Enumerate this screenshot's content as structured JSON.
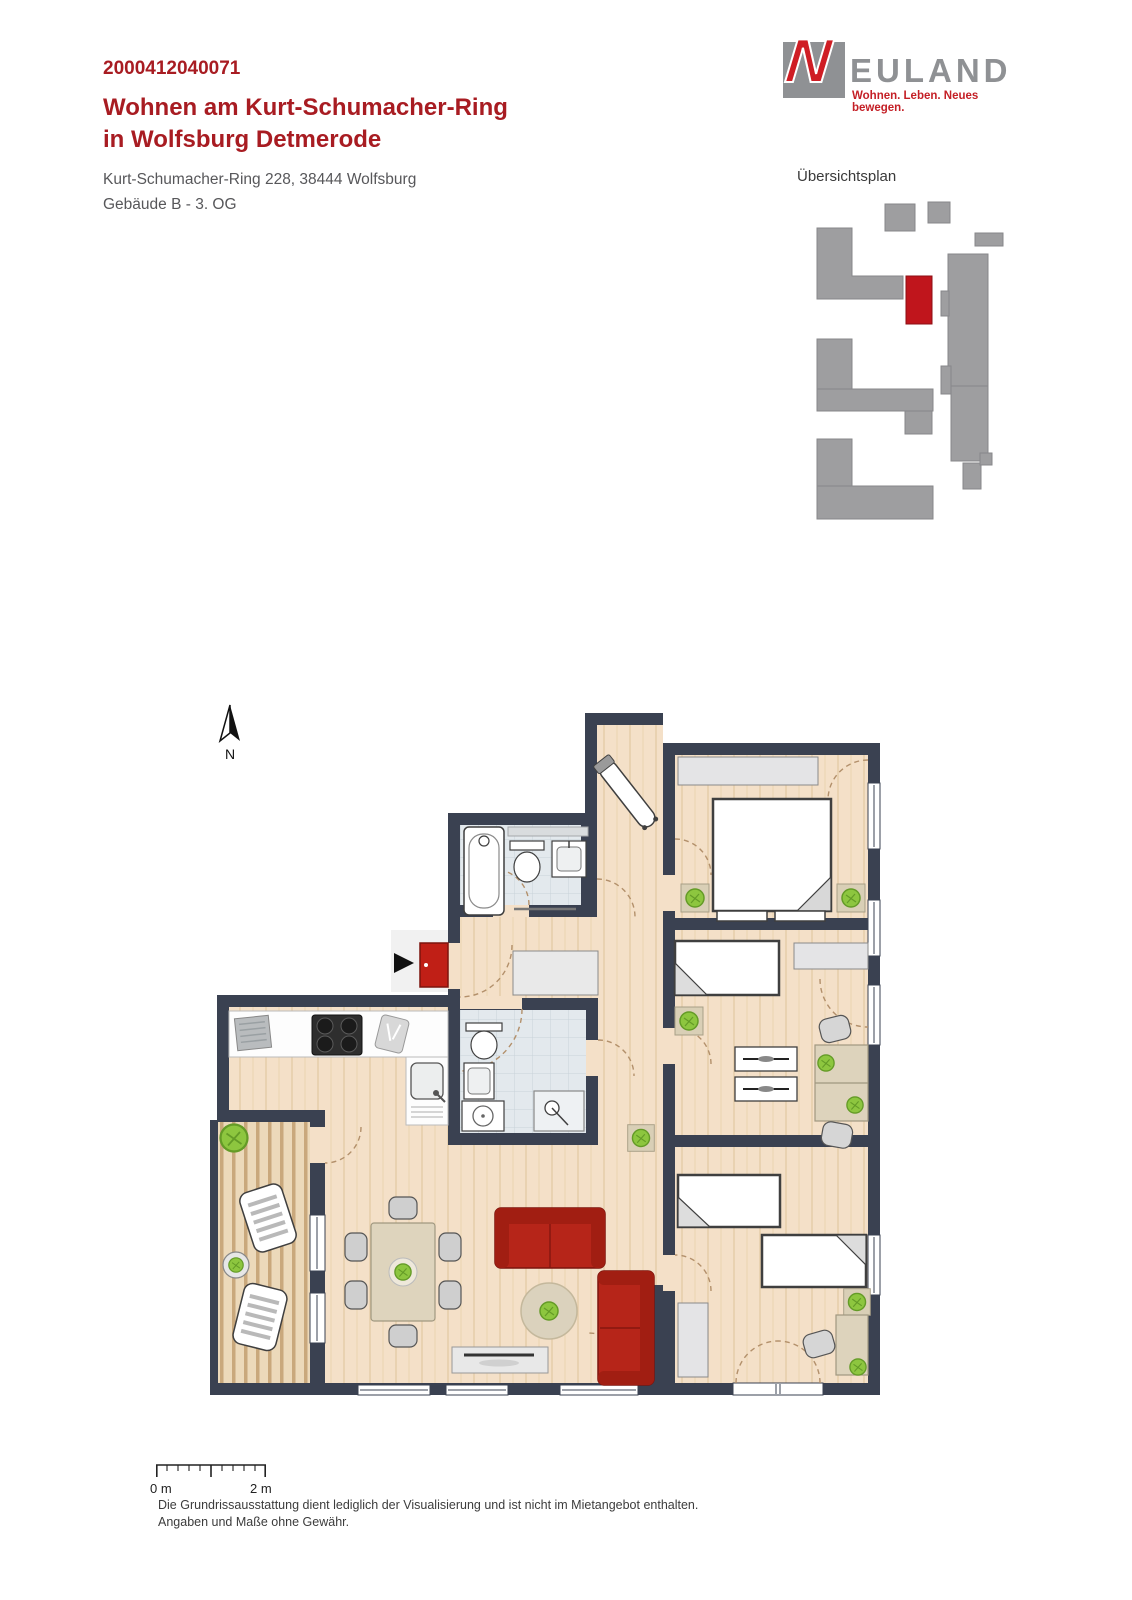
{
  "header": {
    "listing_id": "2000412040071",
    "title_line1": "Wohnen am Kurt-Schumacher-Ring",
    "title_line2": "in Wolfsburg Detmerode",
    "address": "Kurt-Schumacher-Ring 228, 38444 Wolfsburg",
    "building_floor": "Gebäude B - 3. OG",
    "accent_color": "#a81c22"
  },
  "logo": {
    "initial": "N",
    "wordmark_rest": "EULAND",
    "tagline": "Wohnen. Leben. Neues bewegen.",
    "brand_red": "#cf1d24",
    "brand_gray": "#8f9194"
  },
  "overview_plan": {
    "label": "Übersichtsplan",
    "building_color": "#9e9ea0",
    "highlight_color": "#c0151c"
  },
  "floor_plan": {
    "compass_label": "N",
    "wall_color": "#3a4151",
    "wood_floor_color": "#f4e0c8",
    "tile_color": "#e3e9ed",
    "accent_red": "#bb2318",
    "plant_green": "#8dc63f"
  },
  "scale_bar": {
    "start_label": "0 m",
    "end_label": "2 m"
  },
  "footer": {
    "line1": "Die Grundrissausstattung dient lediglich der Visualisierung und ist nicht im Mietangebot enthalten.",
    "line2": "Angaben und Maße ohne Gewähr."
  }
}
